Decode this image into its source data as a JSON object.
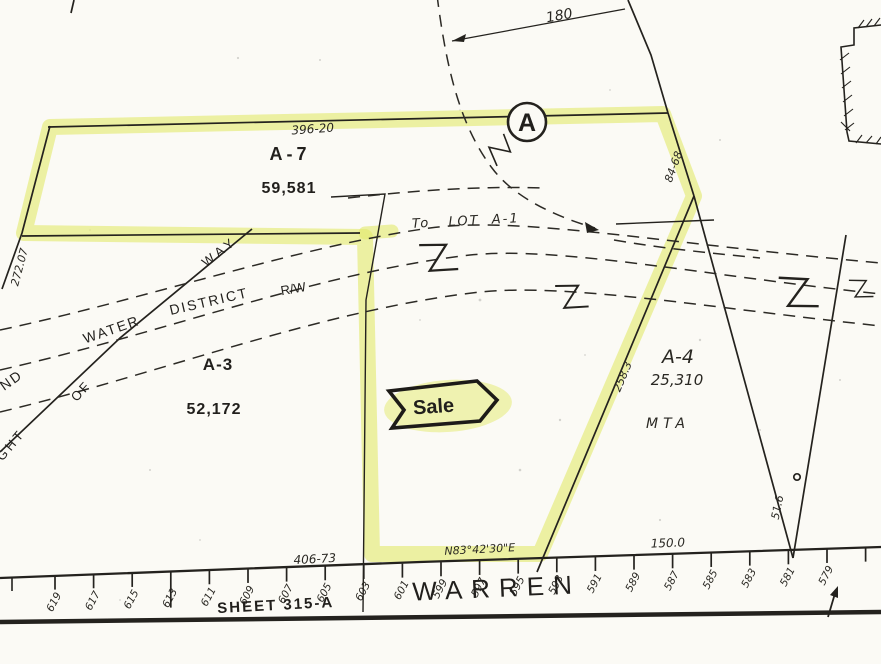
{
  "doc": {
    "type": "scanned plat map"
  },
  "colors": {
    "paper": "#fbfaf5",
    "ink": "#24221e",
    "highlight": "#e3e96b"
  },
  "marker": {
    "label": "A"
  },
  "parcels": {
    "a7": {
      "id": "A-7",
      "area": "59,581"
    },
    "a3": {
      "id": "A-3",
      "area": "52,172"
    },
    "a4": {
      "id": "A-4",
      "area": "25,310",
      "owner": "MTA"
    }
  },
  "dimensions": {
    "arc": "180",
    "a7_top": "396-20",
    "a7_left": "272.07",
    "ne_edge": "84-68",
    "sale_east": "258.3",
    "a4_east": "51.6",
    "frontage_west": "406-73",
    "bearing": "N83°42'30\"E",
    "frontage_east": "150.0"
  },
  "notes": {
    "to_lot": "To   LOT  A-1",
    "sale": "Sale"
  },
  "right_of_way": {
    "word_way": "WAY",
    "word_district": "DISTRICT",
    "word_water": "WATER",
    "word_rw": "R/W",
    "frag_nd": "ND",
    "word_of": "OF",
    "frag_right": "RIGHT"
  },
  "street": {
    "name": "WARREN",
    "sheet_label": "SHEET 315-A",
    "numbers": [
      "619",
      "617",
      "615",
      "613",
      "611",
      "609",
      "607",
      "605",
      "603",
      "601",
      "599",
      "597",
      "595",
      "593",
      "591",
      "589",
      "587",
      "585",
      "583",
      "581",
      "579"
    ]
  }
}
